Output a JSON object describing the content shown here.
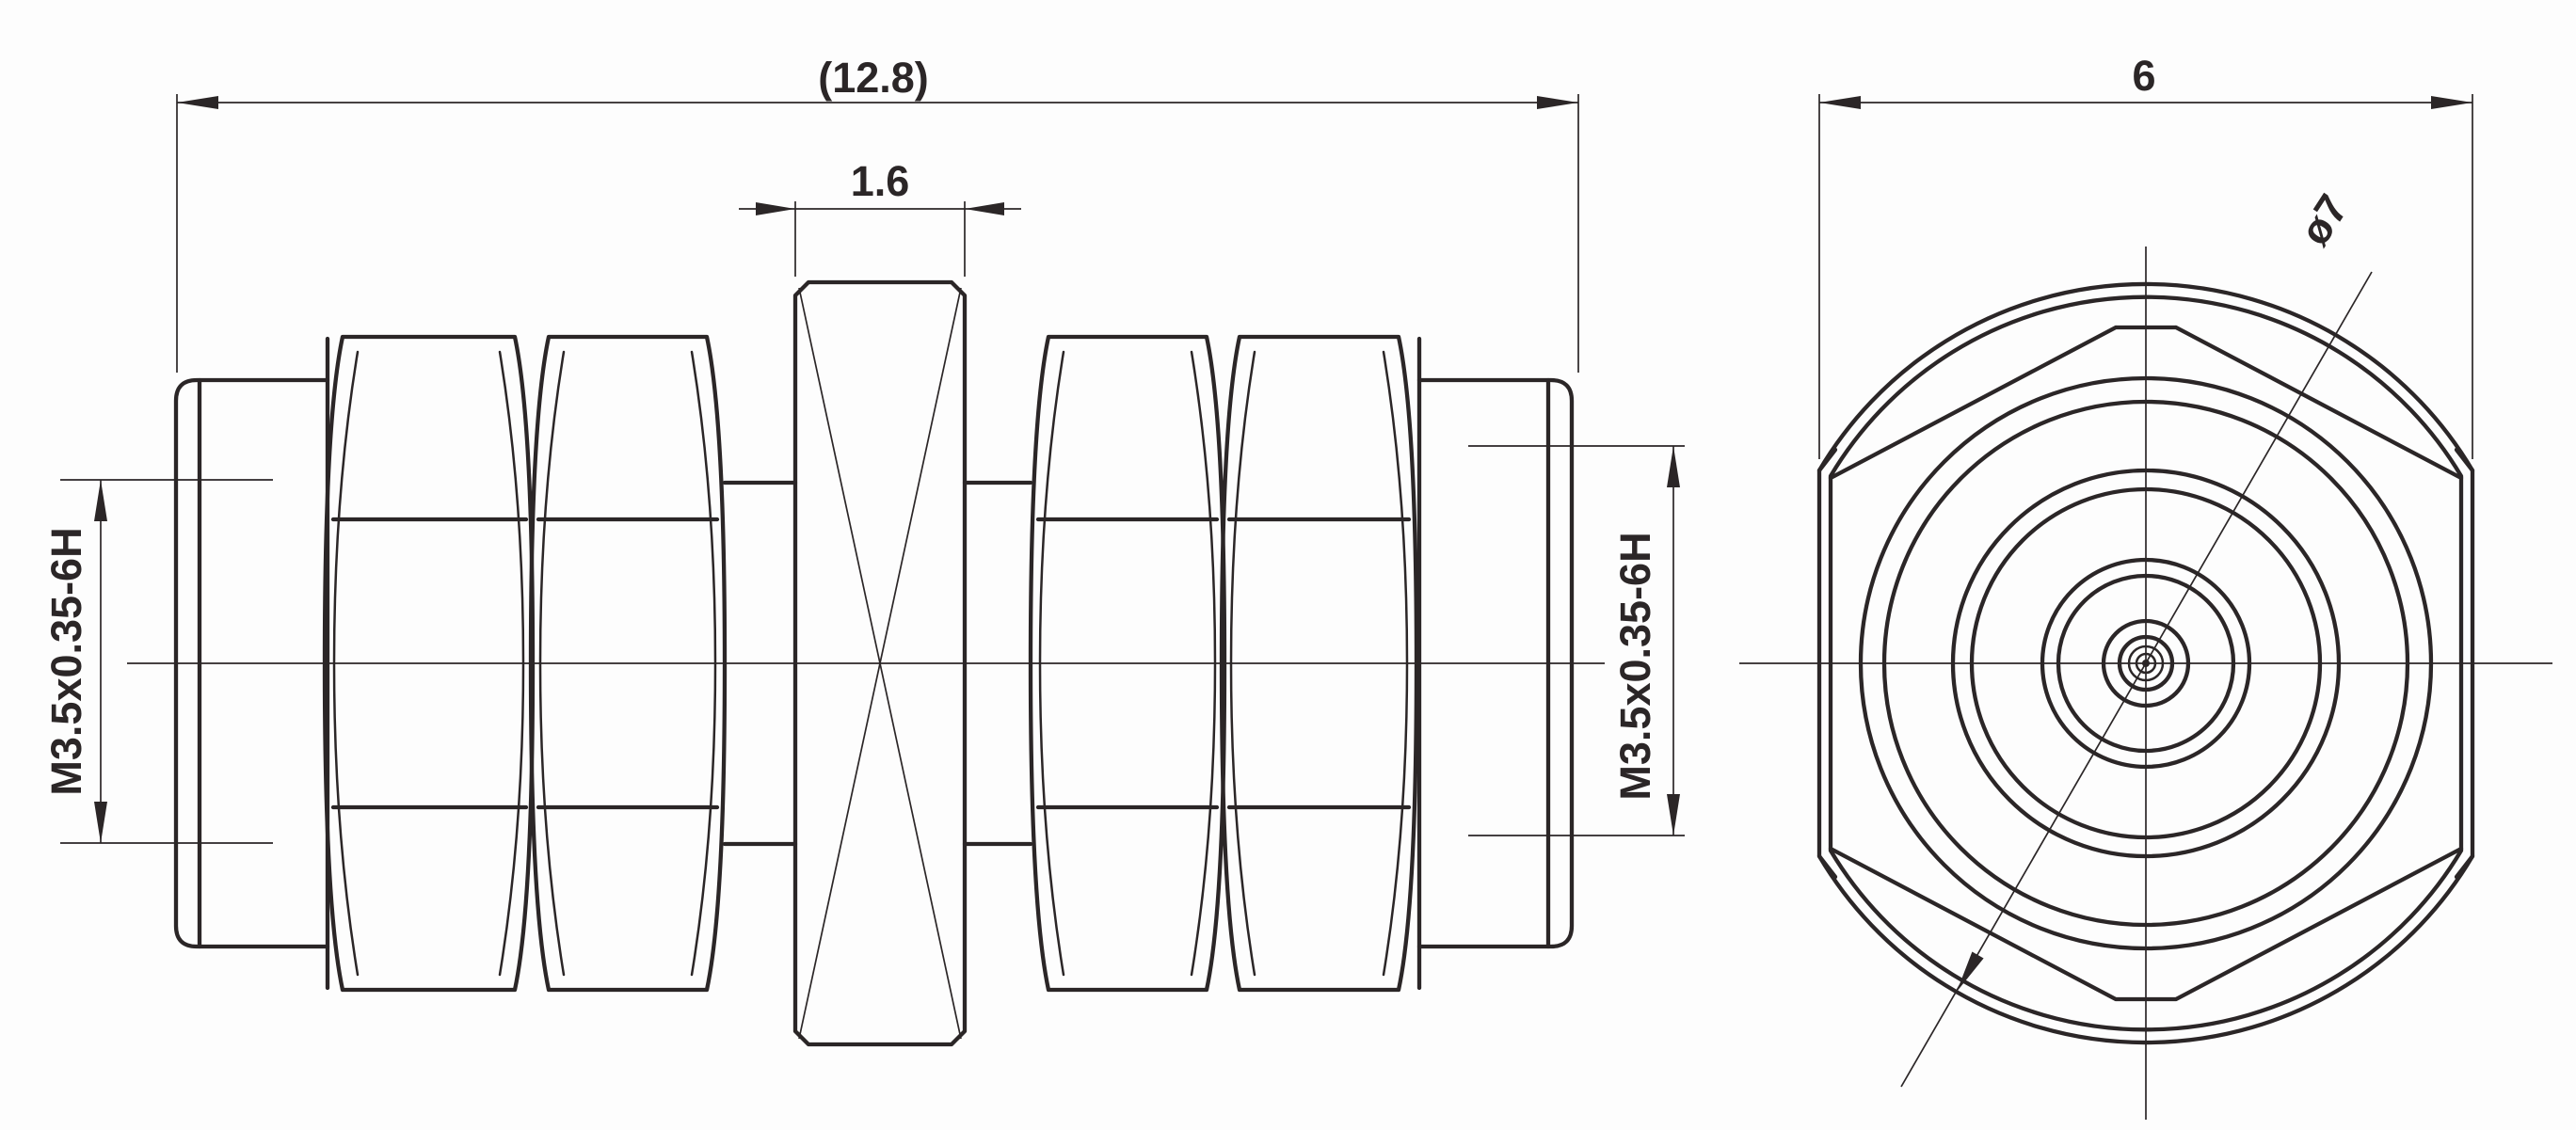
{
  "drawing": {
    "background": "#fdfdfd",
    "line_color": "#2b2627",
    "dimensions": {
      "overall_length": "(12.8)",
      "bulkhead_thickness": "1.6",
      "thread_left": "M3.5x0.35-6H",
      "thread_right": "M3.5x0.35-6H",
      "hex_across_flats": "6",
      "flange_diameter": "ø7"
    },
    "views": {
      "side_view_label": "side-view",
      "end_view_label": "end-view"
    }
  }
}
